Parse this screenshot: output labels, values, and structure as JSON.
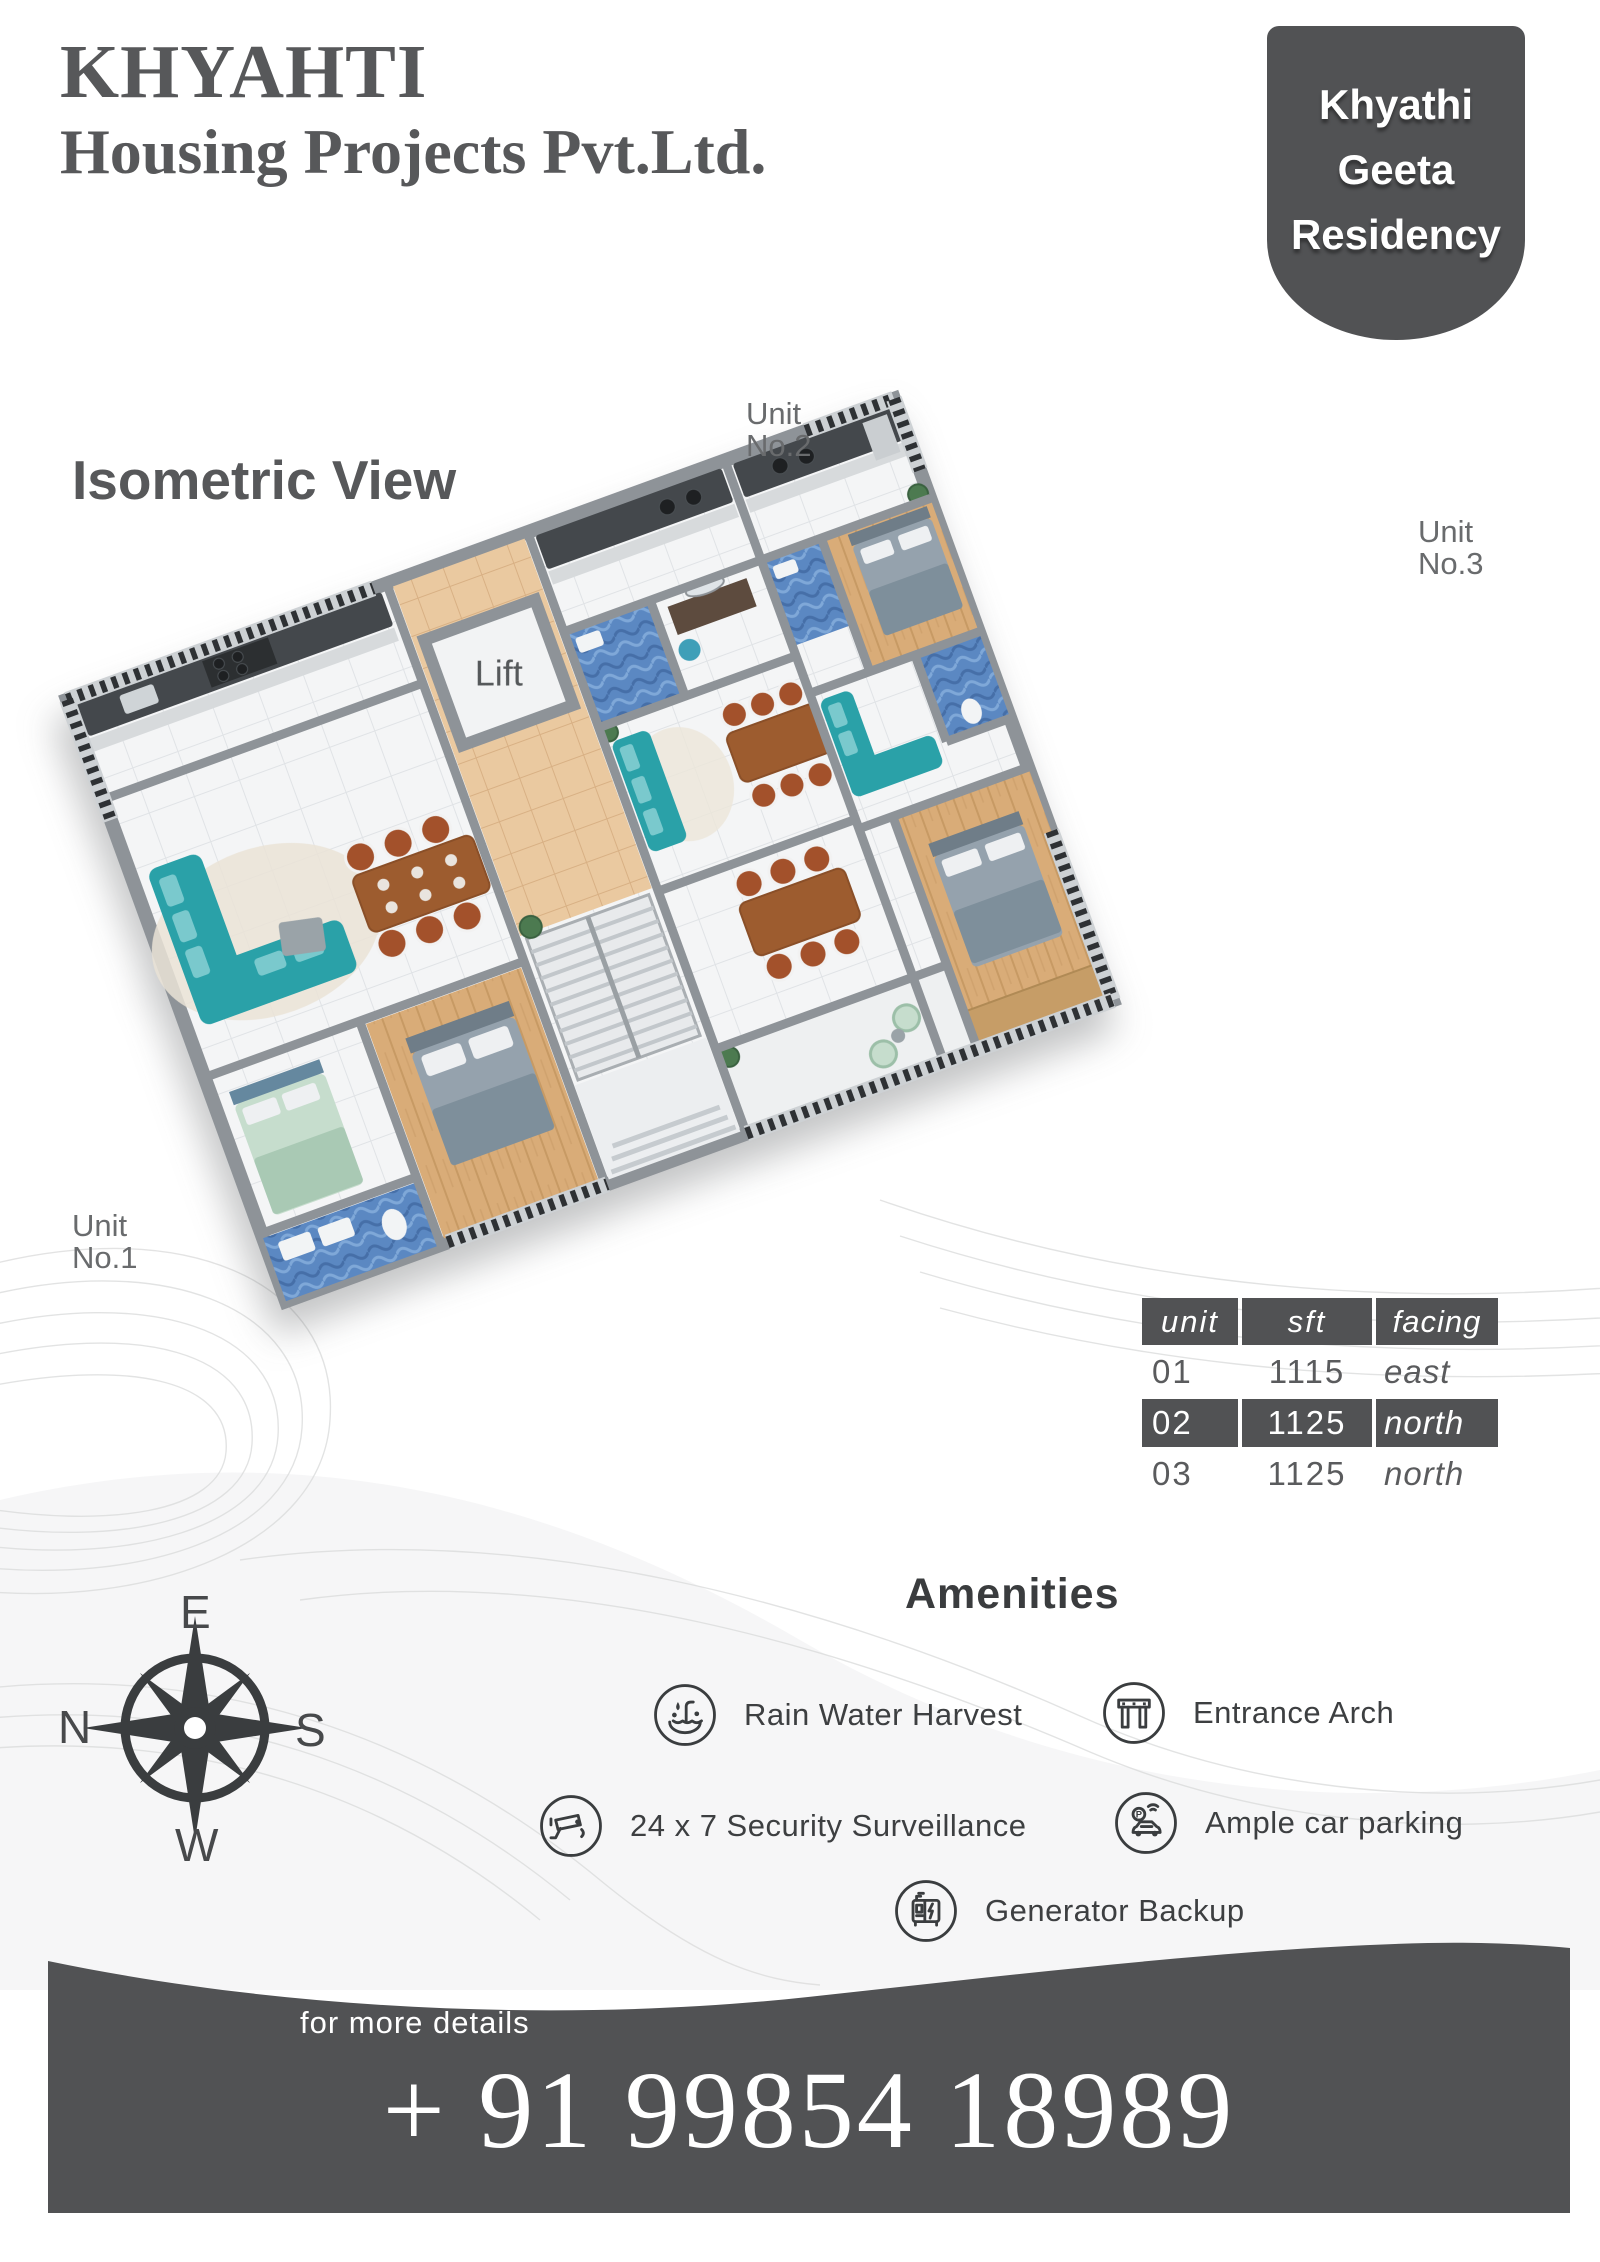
{
  "header": {
    "company_line1": "KHYAHTI",
    "company_line2": "Housing Projects Pvt.Ltd.",
    "badge_lines": [
      "Khyathi",
      "Geeta",
      "Residency"
    ]
  },
  "plan": {
    "view_title": "Isometric View",
    "lift_label": "Lift",
    "unit_labels": [
      {
        "line1": "Unit",
        "line2": "No.1"
      },
      {
        "line1": "Unit",
        "line2": "No.2"
      },
      {
        "line1": "Unit",
        "line2": "No.3"
      }
    ]
  },
  "units_table": {
    "headers": [
      "unit",
      "sft",
      "facing"
    ],
    "rows": [
      {
        "unit": "01",
        "sft": "1115",
        "facing": "east",
        "highlighted": false
      },
      {
        "unit": "02",
        "sft": "1125",
        "facing": "north",
        "highlighted": true
      },
      {
        "unit": "03",
        "sft": "1125",
        "facing": "north",
        "highlighted": false
      }
    ]
  },
  "compass": {
    "top": "E",
    "left": "N",
    "right": "S",
    "bottom": "W"
  },
  "amenities": {
    "title": "Amenities",
    "items": [
      {
        "label": "Rain Water Harvest",
        "icon": "rain-water-harvest-icon"
      },
      {
        "label": "Entrance Arch",
        "icon": "entrance-arch-icon"
      },
      {
        "label": "24 x 7 Security Surveillance",
        "icon": "cctv-camera-icon"
      },
      {
        "label": "Ample car parking",
        "icon": "car-parking-icon",
        "icon_letter": "P"
      },
      {
        "label": "Generator Backup",
        "icon": "generator-icon"
      }
    ]
  },
  "footer": {
    "more_details": "for more details",
    "phone": "+ 91 99854 18989"
  },
  "palette": {
    "dark_gray": "#515254",
    "text_gray": "#57585a",
    "label_gray": "#696b6d",
    "teal": "#2aa1a8",
    "wood": "#d9ac78",
    "bath_blue": "#5b88c2",
    "corridor_tan": "#eac9a0",
    "wall_gray": "#8e9398",
    "railing_dark": "#2e3134",
    "chair_rust": "#a3512b",
    "table_brown": "#9d5c2f",
    "mint": "#c6ddcd"
  }
}
